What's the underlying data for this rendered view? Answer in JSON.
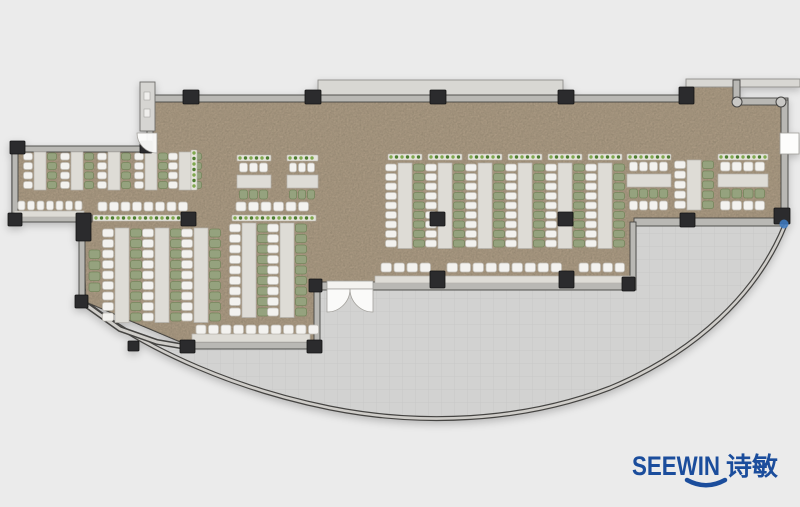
{
  "meta": {
    "type": "office-floor-plan",
    "canvas_w": 800,
    "canvas_h": 507
  },
  "logo": {
    "text_en": "SEEWIN",
    "text_cn": "诗敏",
    "color": "#1b4d9c"
  },
  "palette": {
    "bg": "#ebebeb",
    "floor": "#ab9a83",
    "floor_speckle": "#8a7a62",
    "terrace": "#d2d2d1",
    "terrace_line": "#c8c8c7",
    "wall_fill": "#b9b8b4",
    "wall_stroke": "#454442",
    "wall_core": "#cfcdc9",
    "outline": "#3f3e3c",
    "band": "#d8d7d3",
    "band_stroke": "#8f8e8b",
    "column": "#2b2b2d",
    "column_stroke": "#141414",
    "table": "#dedcd6",
    "table_stroke": "#b6b3ad",
    "chair_white": "#f3f2ef",
    "chair_white_stroke": "#c1beb7",
    "chair_green": "#95a27e",
    "chair_green_stroke": "#75865c",
    "planter_base": "#e6e4dc",
    "planter_stroke": "#b9b6ae",
    "planter_dot_a": "#4e7d31",
    "planter_dot_b": "#7fa84e",
    "door_fill": "#fdfdfc",
    "door_stroke": "#a19f9a",
    "vestibule_fill": "#d6d5d2",
    "vestibule_stroke": "#6e6d6a",
    "joint_fill": "#c9c8c5",
    "marker_blue": "#3f7cc4"
  },
  "plan": {
    "floor_path": "M150,96 L688,96 L688,85 L737,85 L737,101 L783,101 L783,222 L634,222 L634,288 L316,288 L316,346 L190,346 L86,302 L82,218 L12,218 L12,147 L150,147 Z",
    "terrace_path": "M192,348 L316,348 L316,289 L634,289 L634,225 L785,225 C757,294 696,352 610,388 C522,422 420,426 330,408 C240,390 148,352 86,303 L122,329 L158,342 Z",
    "curve_path": "M785,225 C757,294 696,352 610,388 C522,422 420,426 330,408 C240,390 148,352 86,303",
    "diag_path": "M82,302 L120,329 L157,342 L192,348",
    "bands": [
      [
        318,
        80,
        245,
        16
      ],
      [
        686,
        79,
        114,
        8
      ]
    ],
    "walls": [
      [
        150,
        95,
        540,
        7
      ],
      [
        733,
        80,
        7,
        24
      ],
      [
        733,
        98,
        55,
        7
      ],
      [
        781,
        100,
        7,
        124
      ],
      [
        634,
        218,
        150,
        8
      ],
      [
        630,
        222,
        6,
        68
      ],
      [
        316,
        282,
        12,
        8
      ],
      [
        372,
        282,
        262,
        8
      ],
      [
        314,
        288,
        6,
        60
      ],
      [
        188,
        342,
        130,
        7
      ],
      [
        12,
        146,
        138,
        6
      ],
      [
        12,
        146,
        6,
        76
      ],
      [
        12,
        215,
        80,
        7
      ],
      [
        79,
        218,
        6,
        86
      ],
      [
        147,
        128,
        6,
        22
      ]
    ],
    "corner_joints": [
      [
        737,
        102
      ],
      [
        781,
        102
      ]
    ],
    "columns": [
      [
        183,
        90,
        16,
        14
      ],
      [
        305,
        90,
        16,
        14
      ],
      [
        430,
        90,
        16,
        14
      ],
      [
        558,
        90,
        16,
        14
      ],
      [
        679,
        87,
        15,
        17
      ],
      [
        140,
        141,
        12,
        12
      ],
      [
        10,
        141,
        15,
        13
      ],
      [
        8,
        213,
        14,
        13
      ],
      [
        76,
        213,
        15,
        28
      ],
      [
        181,
        212,
        15,
        14
      ],
      [
        430,
        212,
        15,
        14
      ],
      [
        558,
        212,
        15,
        14
      ],
      [
        680,
        213,
        15,
        14
      ],
      [
        774,
        208,
        16,
        16
      ],
      [
        309,
        279,
        13,
        13
      ],
      [
        430,
        271,
        15,
        17
      ],
      [
        559,
        271,
        15,
        17
      ],
      [
        622,
        277,
        13,
        14
      ],
      [
        75,
        295,
        13,
        13
      ],
      [
        128,
        341,
        11,
        10
      ],
      [
        180,
        340,
        15,
        13
      ],
      [
        307,
        340,
        15,
        13
      ]
    ],
    "v_runs": [
      {
        "cx": 40,
        "y": 152,
        "seats": 4,
        "pitch": 9.5,
        "sw": 12,
        "cw": 9,
        "planter": false
      },
      {
        "cx": 77,
        "y": 152,
        "seats": 4,
        "pitch": 9.5,
        "sw": 12,
        "cw": 9,
        "planter": false
      },
      {
        "cx": 114,
        "y": 152,
        "seats": 4,
        "pitch": 9.5,
        "sw": 12,
        "cw": 9,
        "planter": false
      },
      {
        "cx": 151,
        "y": 152,
        "seats": 4,
        "pitch": 9.5,
        "sw": 12,
        "cw": 9,
        "planter": false
      },
      {
        "cx": 185,
        "y": 152,
        "seats": 4,
        "pitch": 9.5,
        "sw": 12,
        "cw": 9,
        "planter": false
      },
      {
        "cx": 122,
        "y": 228,
        "seats": 9,
        "pitch": 10.5,
        "sw": 14,
        "cw": 11,
        "planter": false
      },
      {
        "cx": 162,
        "y": 228,
        "seats": 9,
        "pitch": 10.5,
        "sw": 14,
        "cw": 11,
        "planter": false
      },
      {
        "cx": 201,
        "y": 228,
        "seats": 9,
        "pitch": 10.5,
        "sw": 14,
        "cw": 11,
        "planter": false
      },
      {
        "cx": 249,
        "y": 223,
        "seats": 9,
        "pitch": 10.5,
        "sw": 14,
        "cw": 11,
        "planter": false
      },
      {
        "cx": 287,
        "y": 223,
        "seats": 9,
        "pitch": 10.5,
        "sw": 14,
        "cw": 11,
        "planter": false
      },
      {
        "cx": 405,
        "y": 163,
        "seats": 9,
        "pitch": 9.5,
        "sw": 14,
        "cw": 11,
        "planter": true
      },
      {
        "cx": 445,
        "y": 163,
        "seats": 9,
        "pitch": 9.5,
        "sw": 14,
        "cw": 11,
        "planter": true
      },
      {
        "cx": 485,
        "y": 163,
        "seats": 9,
        "pitch": 9.5,
        "sw": 14,
        "cw": 11,
        "planter": true
      },
      {
        "cx": 525,
        "y": 163,
        "seats": 9,
        "pitch": 9.5,
        "sw": 14,
        "cw": 11,
        "planter": true
      },
      {
        "cx": 565,
        "y": 163,
        "seats": 9,
        "pitch": 9.5,
        "sw": 14,
        "cw": 11,
        "planter": true
      },
      {
        "cx": 605,
        "y": 163,
        "seats": 9,
        "pitch": 9.5,
        "sw": 14,
        "cw": 11,
        "planter": true
      },
      {
        "cx": 694,
        "y": 160,
        "seats": 5,
        "pitch": 10,
        "sw": 14,
        "cw": 11,
        "planter": false
      }
    ],
    "h_runs": [
      {
        "x": 237,
        "y": 155,
        "w": 34,
        "chairs": 3,
        "extra": false
      },
      {
        "x": 287,
        "y": 155,
        "w": 31,
        "chairs": 3,
        "extra": false
      },
      {
        "x": 627,
        "y": 154,
        "w": 44,
        "chairs": 4,
        "extra": true
      },
      {
        "x": 718,
        "y": 154,
        "w": 50,
        "chairs": 4,
        "extra": true
      }
    ],
    "chair_rows": [
      {
        "x": 18,
        "y": 201,
        "n": 7,
        "pitch": 9.5
      },
      {
        "x": 98,
        "y": 202,
        "n": 8,
        "pitch": 11.5
      },
      {
        "x": 236,
        "y": 202,
        "n": 6,
        "pitch": 12.5
      },
      {
        "x": 381,
        "y": 263,
        "n": 4,
        "pitch": 13
      },
      {
        "x": 447,
        "y": 263,
        "n": 9,
        "pitch": 13
      },
      {
        "x": 579,
        "y": 263,
        "n": 4,
        "pitch": 12
      },
      {
        "x": 196,
        "y": 325,
        "n": 10,
        "pitch": 12.5
      }
    ],
    "green_cols": [
      {
        "x": 89,
        "y": 250,
        "n": 4,
        "pitch": 11
      }
    ],
    "counters": [
      [
        14,
        211,
        70,
        6
      ],
      [
        375,
        276,
        256,
        7
      ],
      [
        192,
        334,
        118,
        8
      ]
    ],
    "planters": [
      [
        191,
        150,
        6,
        40
      ],
      [
        93,
        215,
        102,
        6
      ],
      [
        232,
        215,
        84,
        6
      ]
    ],
    "doors": {
      "entry_box": [
        140,
        82,
        15,
        49
      ],
      "entry_fan": "M157,133 L157,153 A20,20 0 0 1 137,133 Z",
      "mid_box": [
        327,
        281,
        46,
        8
      ],
      "mid_fan_left": "M327,289 L350,289 A23,23 0 0 1 327,312 Z",
      "mid_fan_right": "M373,289 L350,289 A23,23 0 0 0 373,312 Z",
      "right_box": [
        780,
        133,
        19,
        21
      ]
    },
    "marker": [
      784,
      224
    ]
  }
}
